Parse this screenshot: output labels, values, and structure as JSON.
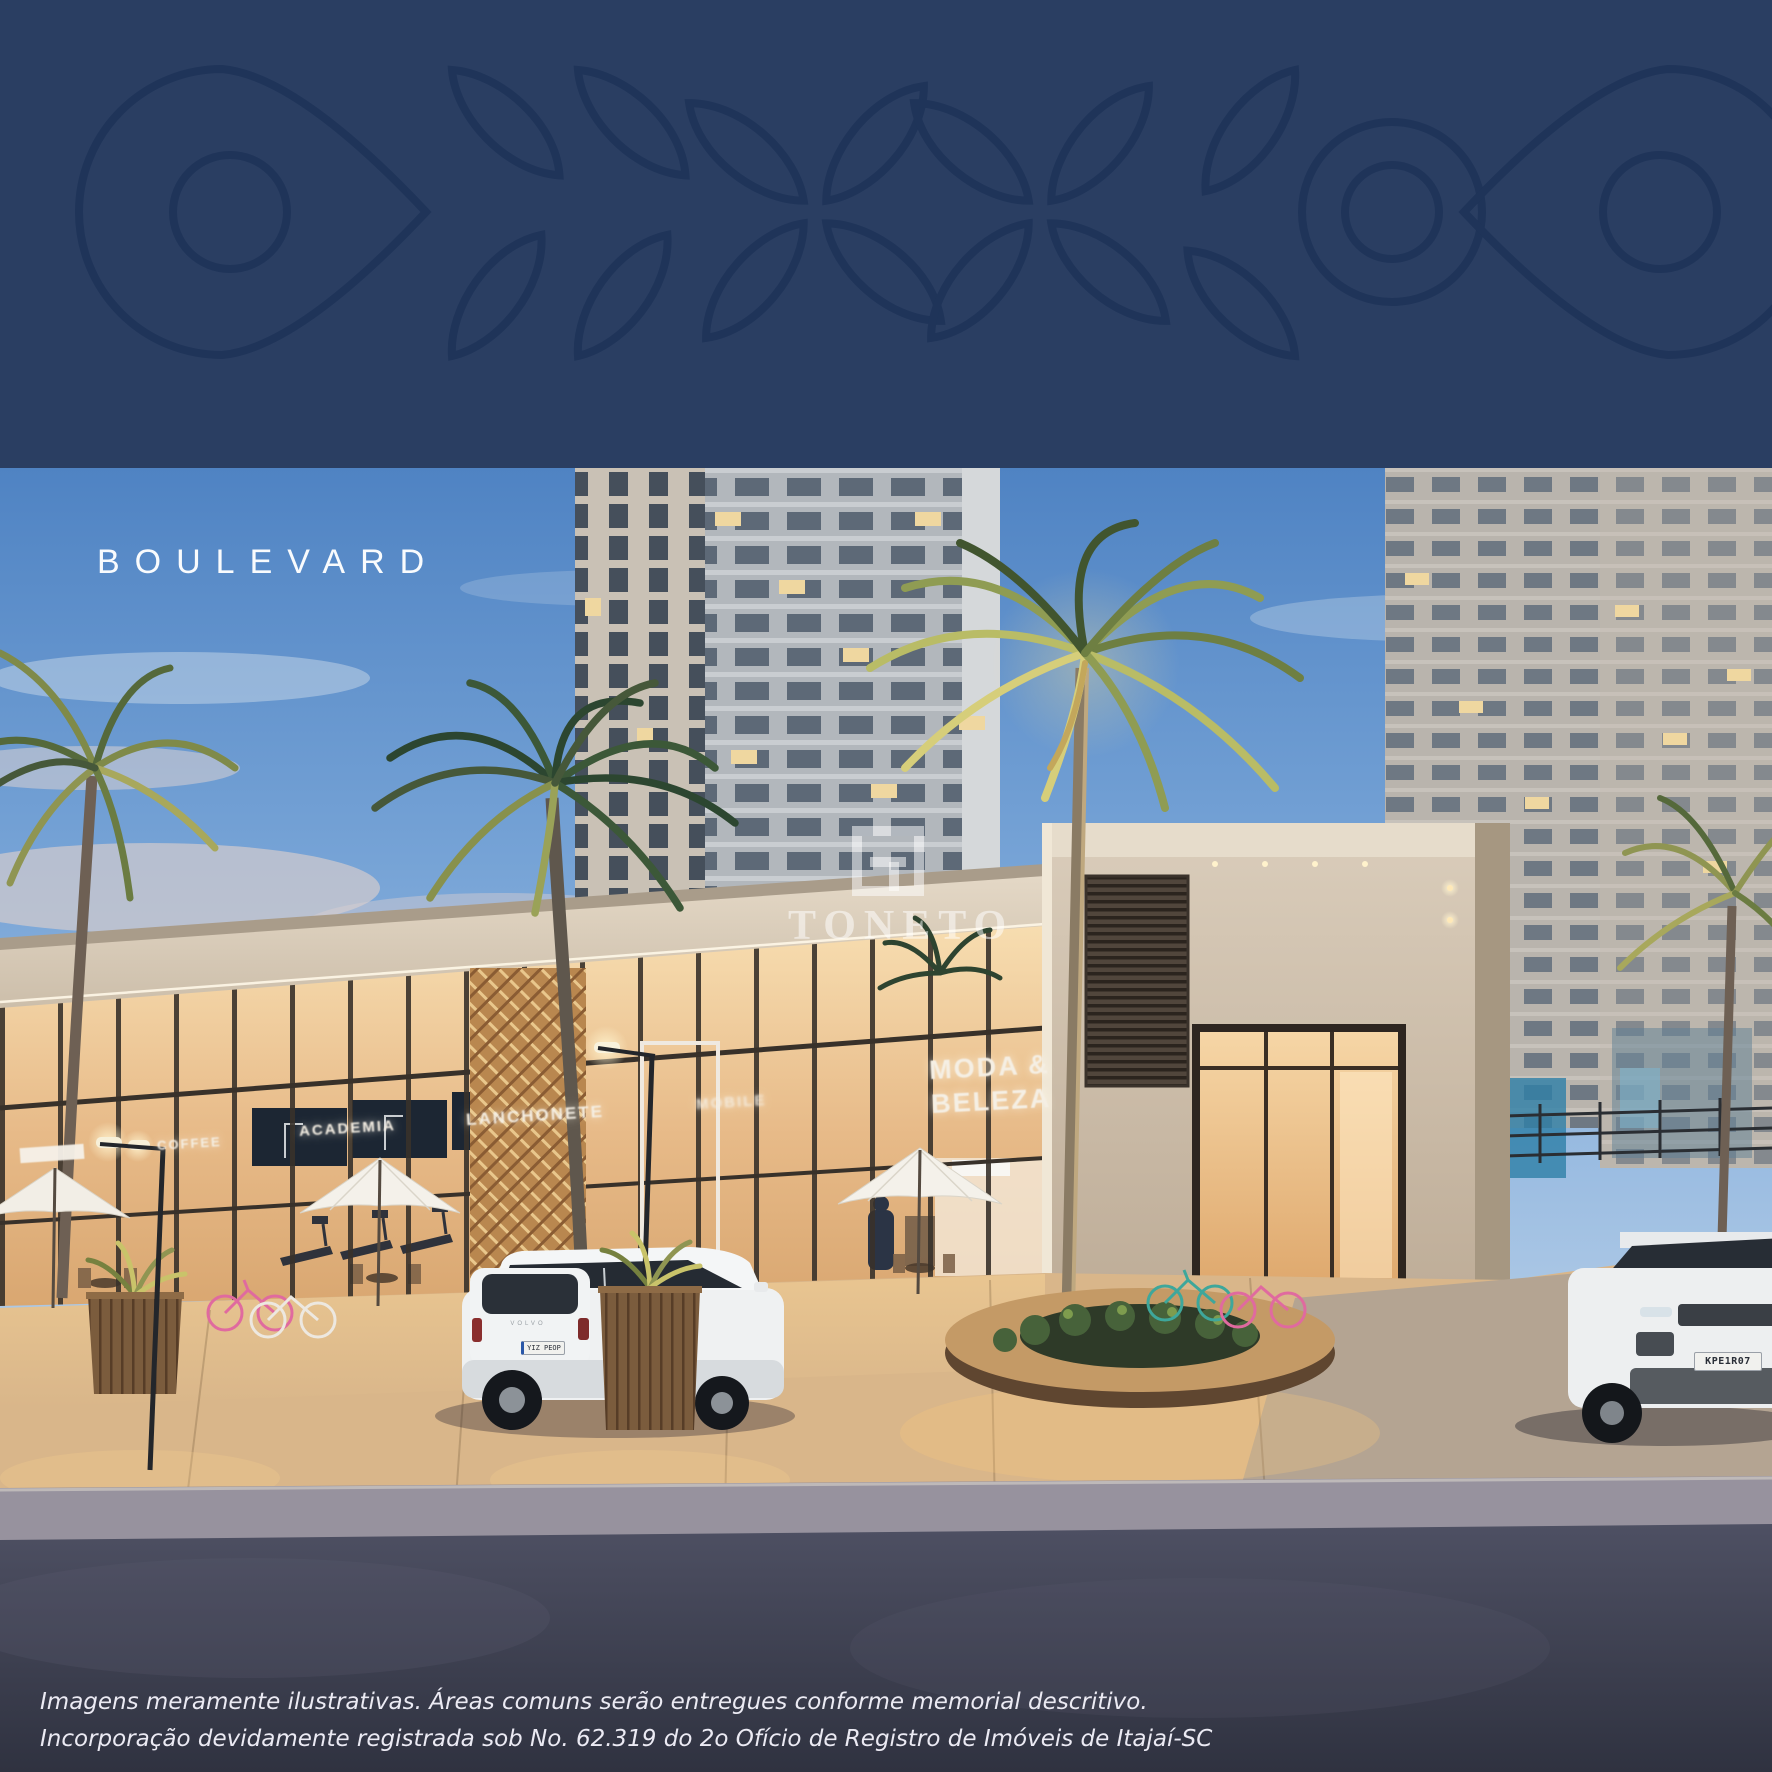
{
  "hero": {
    "title": "BOULEVARD"
  },
  "brand": {
    "watermark": "TONETO"
  },
  "signs": {
    "blank": "",
    "coffee": "COFFEE",
    "academia": "ACADEMIA",
    "lanchonete": "LANCHONETE",
    "mobile": "MOBILE",
    "moda_line1": "MODA &",
    "moda_line2": "BELEZA"
  },
  "vehicles": {
    "volvo_badge": "VOLVO",
    "volvo_plate": "YIZ PEOP",
    "range_plate": "KPE1R07"
  },
  "disclaimer": {
    "line1": "Imagens meramente ilustrativas. Áreas comuns serão entregues conforme memorial descritivo.",
    "line2": "Incorporação devidamente registrada sob No. 62.319 do 2o Ofício de Registro de Imóveis de Itajaí-SC"
  },
  "palette": {
    "band_bg": "#2A3E62",
    "band_stroke": "#1F3459",
    "sky_top": "#4F83C3",
    "glass_glow": "#E9BE8C",
    "fascia": "#D8CCBC",
    "asphalt": "#3A3D4E",
    "palm_lit": "#C9C36A"
  }
}
